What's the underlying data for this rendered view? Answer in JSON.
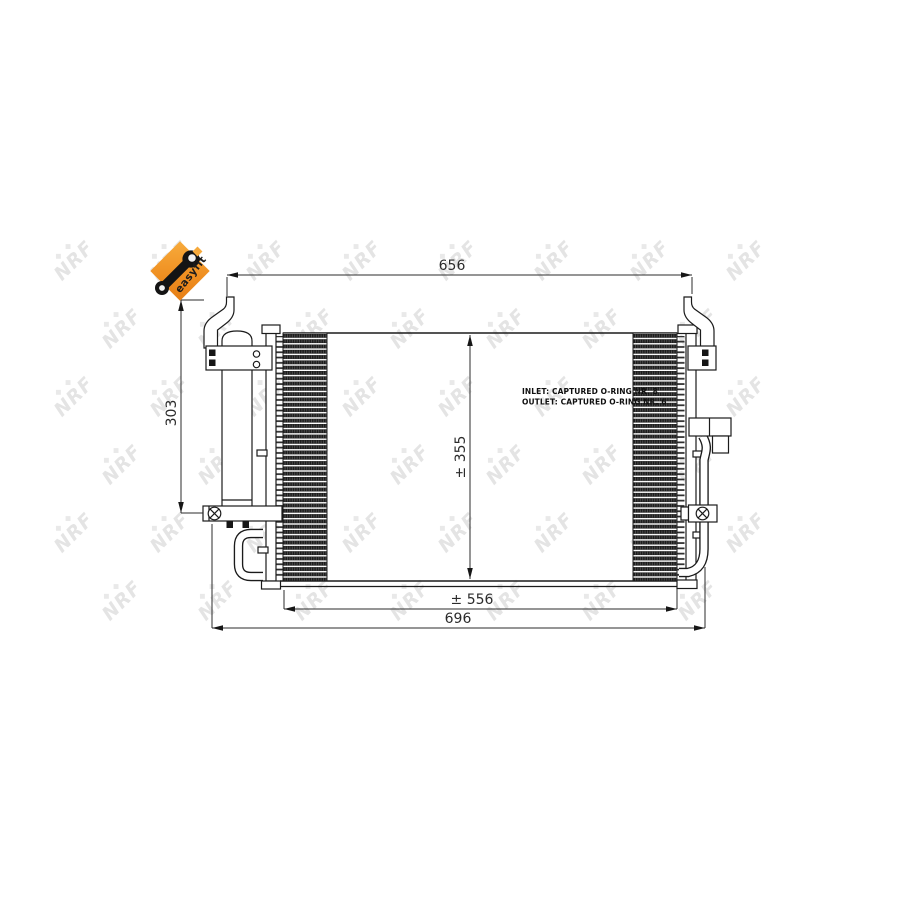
{
  "title": "NRF condenser technical drawing",
  "logo": {
    "easyfit_label": "easyfit"
  },
  "watermark": {
    "text": "NRF",
    "diamonds": "◆ ◆",
    "color": "#e4e4e4"
  },
  "annotations": {
    "inlet": "INLET: CAPTURED O-RING NR. 8",
    "outlet": "OUTLET: CAPTURED O-RING NR. 6"
  },
  "dimensions": {
    "top_width": "656",
    "left_height": "303",
    "core_height": "± 355",
    "core_width": "± 556",
    "overall_width": "696"
  },
  "colors": {
    "line": "#1b1b1b",
    "dimension": "#2b2b2b",
    "logo_orange": "#ef8e20",
    "watermark": "#e4e4e4"
  }
}
